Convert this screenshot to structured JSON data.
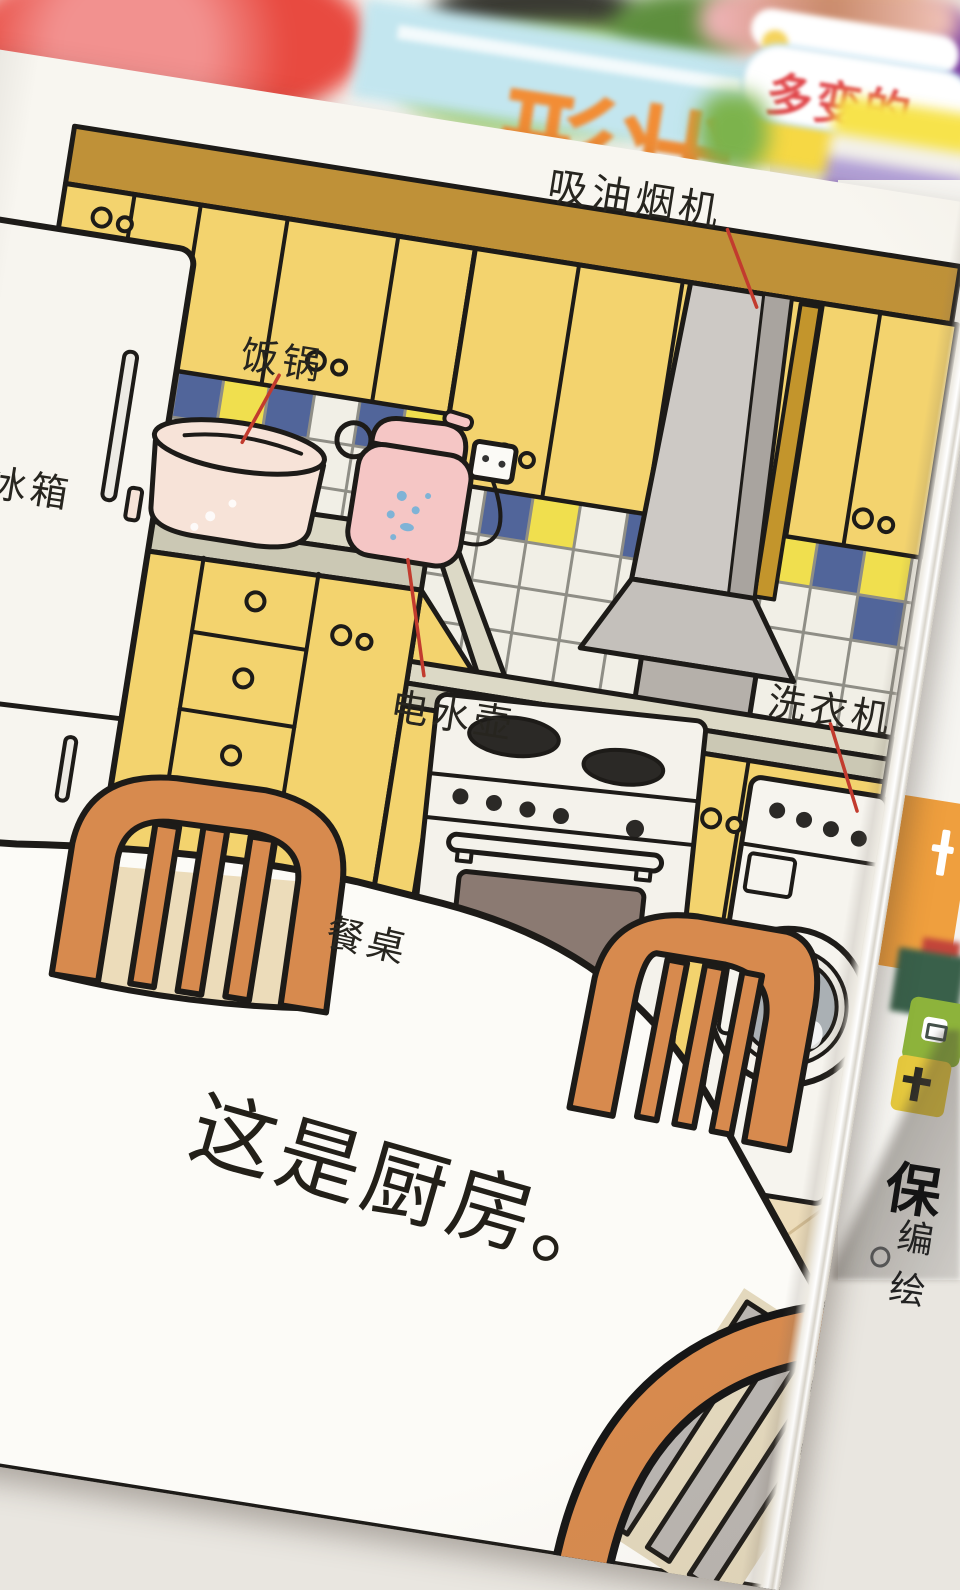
{
  "page": {
    "labels": [
      {
        "id": "fridge",
        "text": "冰箱"
      },
      {
        "id": "rice_cooker",
        "text": "饭锅"
      },
      {
        "id": "range_hood",
        "text": "吸油烟机"
      },
      {
        "id": "kettle",
        "text": "电水壶"
      },
      {
        "id": "washing_machine",
        "text": "洗衣机"
      },
      {
        "id": "dining_table",
        "text": "餐桌"
      }
    ],
    "caption": "这是厨房。"
  },
  "background": {
    "top_book_title_fragment": "形状",
    "right_book_title_fragment": "多变的",
    "under_page": {
      "fragment_1": "保",
      "fragment_2": "编绘"
    }
  },
  "colors": {
    "cabinet_yellow": "#f3d36e",
    "cabinet_band": "#bf9138",
    "tile_blue": "#51659a",
    "tile_yellow": "#f0df4e",
    "tile_cream": "#f1efe6",
    "counter": "#dcd9c6",
    "hood_gray": "#cdc9c5",
    "chair_orange": "#d78a4e",
    "floor": "#ecdcba",
    "pointer_red": "#c23b2e",
    "oven_window_brown": "#8b7a72"
  }
}
